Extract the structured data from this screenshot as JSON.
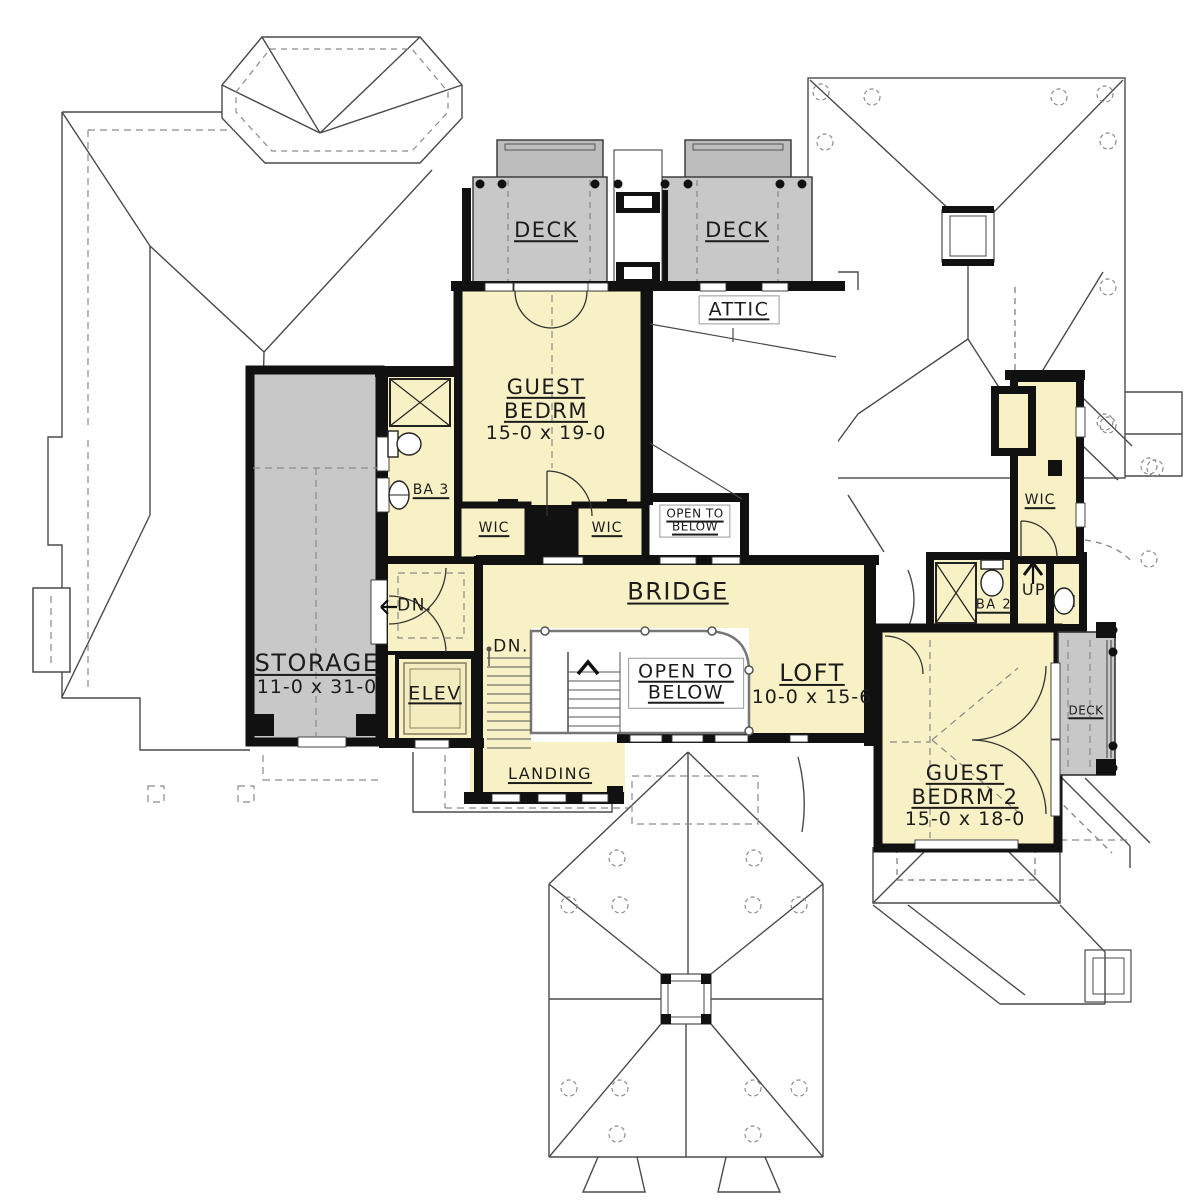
{
  "plan_type": "second-floor-plan",
  "colors": {
    "room_fill": "#F7F1C5",
    "deck_fill": "#C8C8C8",
    "planter_fill": "#BDBDBD",
    "wall": "#111111",
    "roof_line": "#4a4a4a",
    "dash_line": "#8a8a8a"
  },
  "labels": {
    "deck_top_left": "DECK",
    "deck_top_right": "DECK",
    "attic": "ATTIC",
    "guest_bedrm": {
      "l1": "GUEST",
      "l2": "BEDRM",
      "dims": "15-0 x 19-0"
    },
    "ba3": "BA 3",
    "wic_left": "WIC",
    "wic_right": "WIC",
    "open_below_small": {
      "l1": "OPEN TO",
      "l2": "BELOW"
    },
    "storage": {
      "name": "STORAGE",
      "dims": "11-0 x 31-0"
    },
    "dn_hall": "DN.",
    "elevator": "ELEV",
    "bridge": "BRIDGE",
    "dn_stairs": "DN.",
    "open_below_large": {
      "l1": "OPEN TO",
      "l2": "BELOW"
    },
    "loft": {
      "name": "LOFT",
      "dims": "10-0 x 15-6"
    },
    "landing": "LANDING",
    "wic_wing": "WIC",
    "ba2": "BA 2",
    "up": "UP",
    "deck_right": "DECK",
    "guest_bedrm2": {
      "l1": "GUEST",
      "l2": "BEDRM 2",
      "dims": "15-0 x 18-0"
    }
  }
}
